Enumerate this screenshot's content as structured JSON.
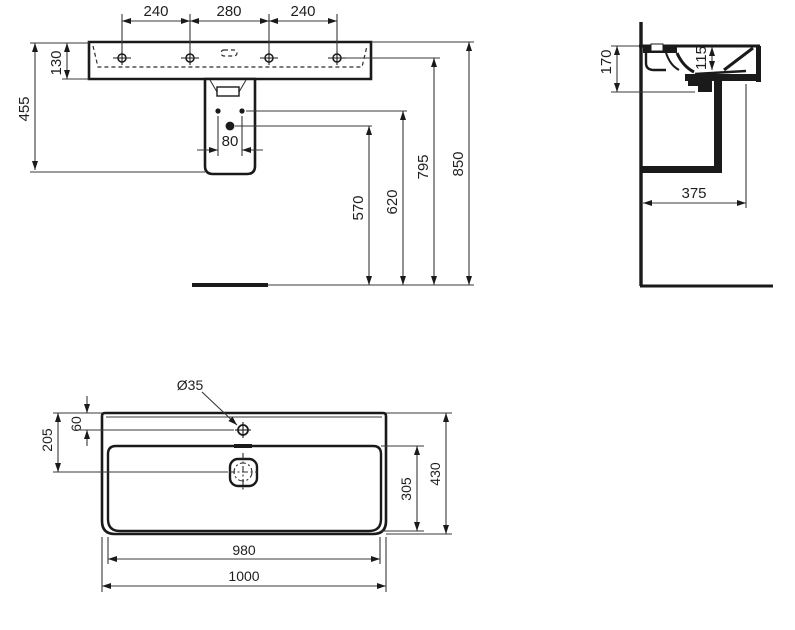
{
  "drawing": {
    "kind": "washbasin-technical-drawing",
    "background": "#ffffff",
    "line_color": "#1a1a1a"
  },
  "views": {
    "front": {
      "dims": {
        "pitch_left": "240",
        "pitch_center": "280",
        "pitch_right": "240",
        "basin_height": "130",
        "overall_height": "455",
        "bolt_spacing": "80",
        "outlet_to_floor": "570",
        "fixings_to_floor": "620",
        "tap_holes_to_floor": "795",
        "rim_to_floor": "850"
      }
    },
    "side": {
      "dims": {
        "front_height": "170",
        "bowl_inner_depth": "115",
        "projection": "375"
      }
    },
    "plan": {
      "dims": {
        "tap_hole_diameter": "Ø35",
        "tap_hole_from_back": "60",
        "drain_from_back": "205",
        "bowl_front_back": "305",
        "overall_depth": "430",
        "bowl_width": "980",
        "overall_width": "1000"
      }
    }
  }
}
